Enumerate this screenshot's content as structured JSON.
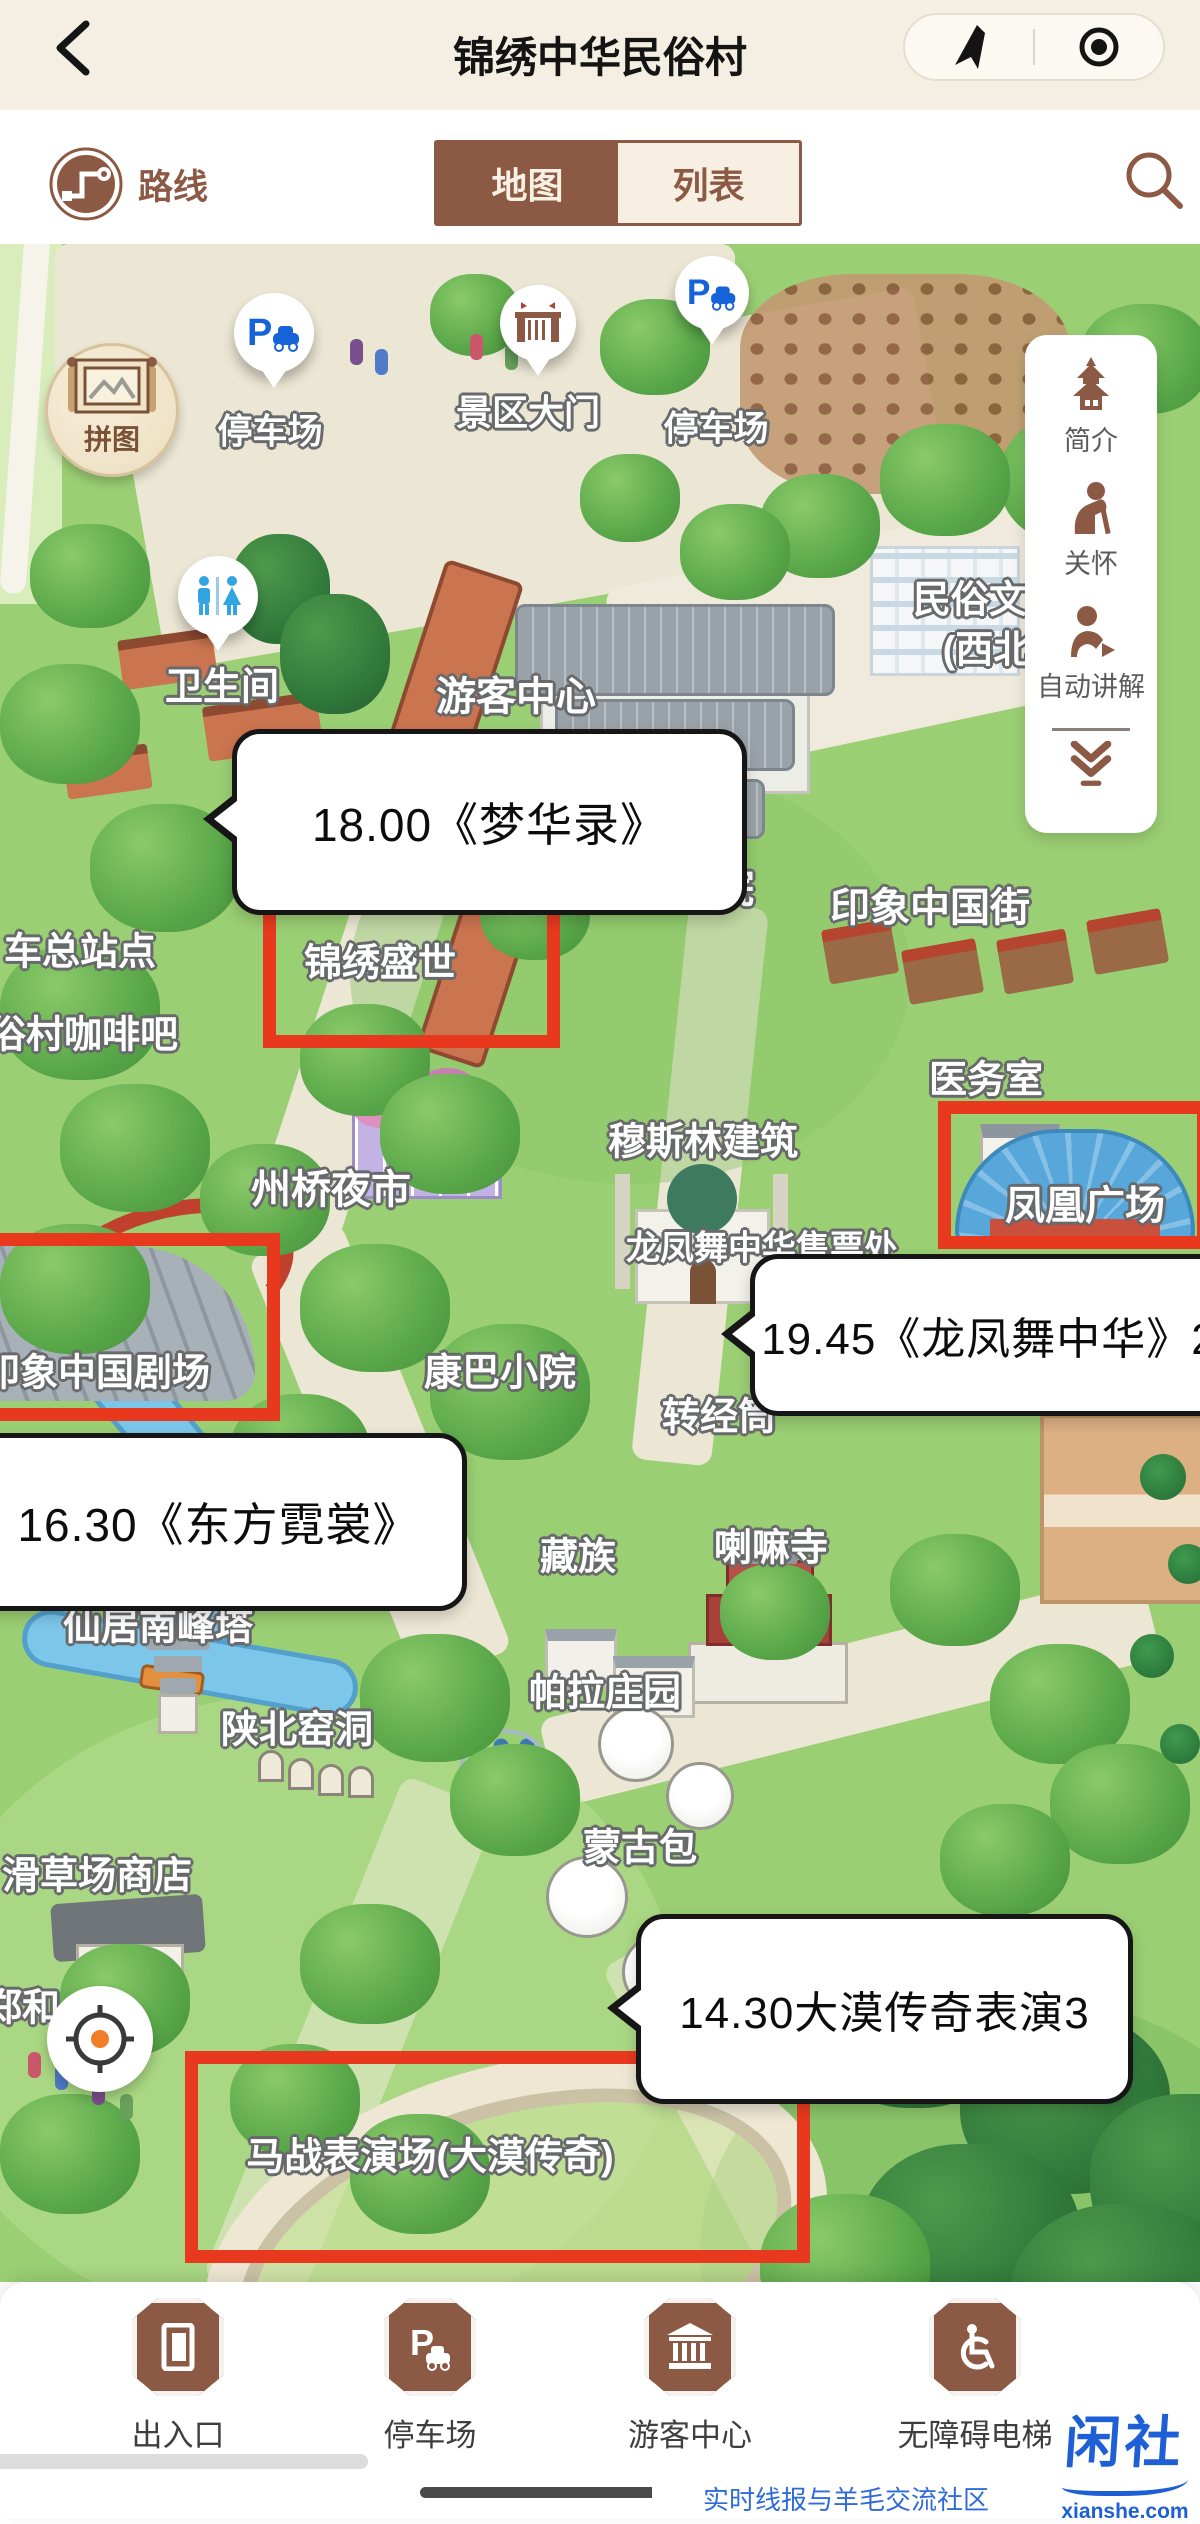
{
  "header": {
    "back_icon": "chevron-left-icon",
    "title": "锦绣中华民俗村",
    "capsule": {
      "share_icon": "nav-arrow-icon",
      "capture_icon": "circle-dot-icon"
    }
  },
  "toolbar": {
    "route_icon": "route-map-icon",
    "route_label": "路线",
    "tab_map": "地图",
    "tab_list": "列表",
    "search_icon": "search-icon"
  },
  "quick_panel": {
    "items": [
      {
        "icon": "pagoda-icon",
        "label": "简介"
      },
      {
        "icon": "elder-care-icon",
        "label": "关怀"
      },
      {
        "icon": "audio-guide-icon",
        "label": "自动讲解"
      }
    ],
    "collapse_icon": "double-chevron-down-icon"
  },
  "map": {
    "puzzle_button": {
      "icon": "scroll-map-icon",
      "label": "拼图"
    },
    "locate_button": {
      "icon": "crosshair-icon"
    },
    "pins": [
      {
        "icon": "parking-icon",
        "label": "停车场"
      },
      {
        "icon": "gate-icon",
        "label": "景区大门"
      },
      {
        "icon": "parking-icon",
        "label": "停车场"
      },
      {
        "icon": "restroom-icon",
        "label": "卫生间"
      }
    ],
    "labels": [
      {
        "text": "游客中心"
      },
      {
        "text": "民俗文"
      },
      {
        "text": "(西北"
      },
      {
        "text": "院"
      },
      {
        "text": "印象中国街"
      },
      {
        "text": "车总站点"
      },
      {
        "text": "俗村咖啡吧"
      },
      {
        "text": "医务室"
      },
      {
        "text": "穆斯林建筑"
      },
      {
        "text": "州桥夜市"
      },
      {
        "text": "龙凤舞中华售票处"
      },
      {
        "text": "康巴小院"
      },
      {
        "text": "转经筒"
      },
      {
        "text": "藏族"
      },
      {
        "text": "喇嘛寺"
      },
      {
        "text": "仙居南峰塔"
      },
      {
        "text": "帕拉庄园"
      },
      {
        "text": "陕北窑洞"
      },
      {
        "text": "蒙古包"
      },
      {
        "text": "滑草场商店"
      },
      {
        "text": "郑和"
      }
    ],
    "highlight_boxes": [
      {
        "label": "锦绣盛世"
      },
      {
        "label": "凤凰广场"
      },
      {
        "label": "印象中国剧场"
      },
      {
        "label": "马战表演场(大漠传奇)"
      }
    ],
    "schedule_bubbles": [
      {
        "text": "18.00《梦华录》"
      },
      {
        "text": "19.45《龙凤舞中华》2"
      },
      {
        "text": "16.30《东方霓裳》"
      },
      {
        "text": "14.30大漠传奇表演3"
      }
    ]
  },
  "bottom_nav": {
    "items": [
      {
        "icon": "door-icon",
        "label": "出入口"
      },
      {
        "icon": "parking-badge-icon",
        "label": "停车场"
      },
      {
        "icon": "visitor-center-icon",
        "label": "游客中心"
      },
      {
        "icon": "wheelchair-icon",
        "label": "无障碍电梯"
      }
    ]
  },
  "watermark": {
    "brand": "闲社",
    "domain": "xianshe.com",
    "tagline": "实时线报与羊毛交流社区"
  },
  "colors": {
    "accent_brown": "#8C5A44",
    "cream": "#F4EFE2",
    "highlight_red": "#E8391E",
    "pin_blue": "#1663D9",
    "restroom_blue": "#31A5E2",
    "watermark_blue": "#1E5FD6"
  }
}
